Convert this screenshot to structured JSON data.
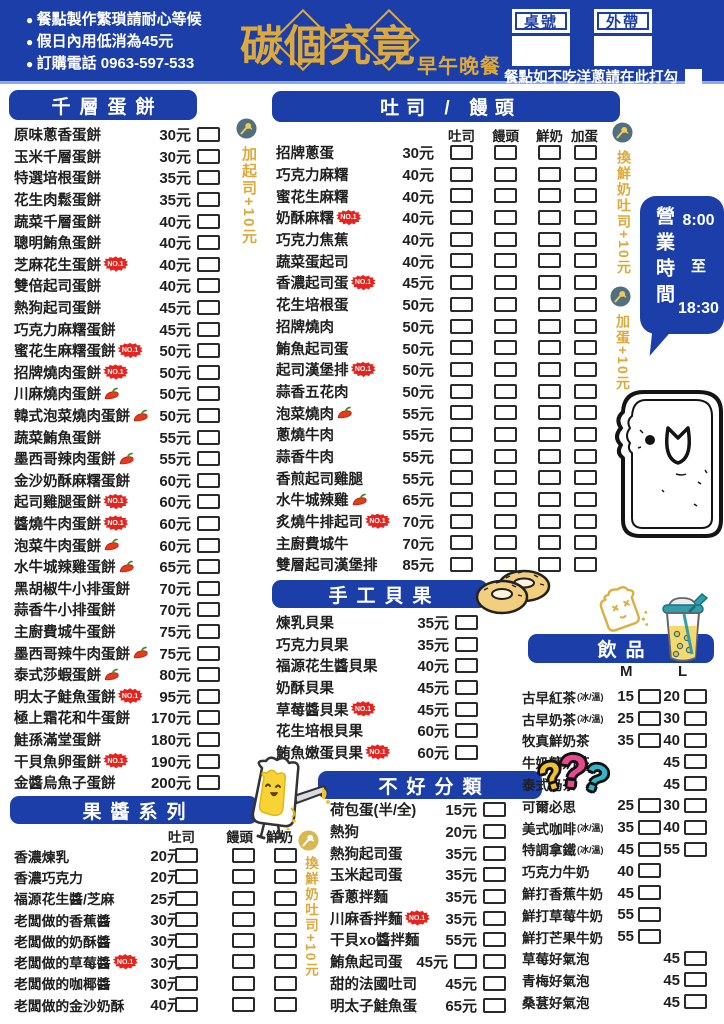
{
  "colors": {
    "blue": "#1b3ea8",
    "gold": "#dca93c",
    "badge_red": "#e8231d"
  },
  "banner": {
    "notes": [
      "餐點製作繁瑣請耐心等候",
      "假日內用低消為45元",
      "訂購電話 0963-597-533"
    ],
    "logo": "碳個究竟",
    "logo_sub": "早午晚餐",
    "table_label": "桌號",
    "takeout_label": "外帶",
    "onion_note": "餐點如不吃洋蔥請在此打勾"
  },
  "side_notes": {
    "add_cheese": "加起司+10元",
    "swap_milk_toast_right": "換鮮奶吐司+10元",
    "add_egg": "加蛋+10元",
    "swap_milk_toast_bottom": "換鮮奶吐司+10元"
  },
  "hours": {
    "title": "營業時間",
    "open": "8:00",
    "to": "至",
    "close": "18:30"
  },
  "badge_no1_label": "NO.1",
  "sections": {
    "egg_pancake": {
      "title": "千層蛋餅",
      "items": [
        {
          "name": "原味蔥香蛋餅",
          "price": "30元"
        },
        {
          "name": "玉米千層蛋餅",
          "price": "30元"
        },
        {
          "name": "特選培根蛋餅",
          "price": "35元"
        },
        {
          "name": "花生肉鬆蛋餅",
          "price": "35元"
        },
        {
          "name": "蔬菜千層蛋餅",
          "price": "40元"
        },
        {
          "name": "聰明鮪魚蛋餅",
          "price": "40元"
        },
        {
          "name": "芝麻花生蛋餅",
          "price": "40元",
          "badge": "no1"
        },
        {
          "name": "雙倍起司蛋餅",
          "price": "40元"
        },
        {
          "name": "熱狗起司蛋餅",
          "price": "45元"
        },
        {
          "name": "巧克力麻糬蛋餅",
          "price": "45元"
        },
        {
          "name": "蜜花生麻糬蛋餅",
          "price": "50元",
          "badge": "no1"
        },
        {
          "name": "招牌燒肉蛋餅",
          "price": "50元",
          "badge": "no1"
        },
        {
          "name": "川麻燒肉蛋餅",
          "price": "50元",
          "badge": "chili"
        },
        {
          "name": "韓式泡菜燒肉蛋餅",
          "price": "50元",
          "badge": "chili"
        },
        {
          "name": "蔬菜鮪魚蛋餅",
          "price": "55元"
        },
        {
          "name": "墨西哥辣肉蛋餅",
          "price": "55元",
          "badge": "chili"
        },
        {
          "name": "金沙奶酥麻糬蛋餅",
          "price": "60元"
        },
        {
          "name": "起司雞腿蛋餅",
          "price": "60元",
          "badge": "no1"
        },
        {
          "name": "醬燒牛肉蛋餅",
          "price": "60元",
          "badge": "no1"
        },
        {
          "name": "泡菜牛肉蛋餅",
          "price": "60元",
          "badge": "chili"
        },
        {
          "name": "水牛城辣雞蛋餅",
          "price": "65元",
          "badge": "chili"
        },
        {
          "name": "黑胡椒牛小排蛋餅",
          "price": "70元"
        },
        {
          "name": "蒜香牛小排蛋餅",
          "price": "70元"
        },
        {
          "name": "主廚費城牛蛋餅",
          "price": "75元"
        },
        {
          "name": "墨西哥辣牛肉蛋餅",
          "price": "75元",
          "badge": "chili"
        },
        {
          "name": "泰式莎蝦蛋餅",
          "price": "80元",
          "badge": "chili"
        },
        {
          "name": "明太子鮭魚蛋餅",
          "price": "95元",
          "badge": "no1"
        },
        {
          "name": "極上霜花和牛蛋餅",
          "price": "170元"
        },
        {
          "name": "鮭孫滿堂蛋餅",
          "price": "180元"
        },
        {
          "name": "干貝魚卵蛋餅",
          "price": "190元",
          "badge": "no1"
        },
        {
          "name": "金醬烏魚子蛋餅",
          "price": "200元"
        }
      ]
    },
    "toast_mantou": {
      "title": "吐司 / 饅頭",
      "columns": [
        "吐司",
        "饅頭",
        "鮮奶",
        "加蛋"
      ],
      "items": [
        {
          "name": "招牌蔥蛋",
          "price": "30元"
        },
        {
          "name": "巧克力麻糬",
          "price": "40元"
        },
        {
          "name": "蜜花生麻糬",
          "price": "40元"
        },
        {
          "name": "奶酥麻糬",
          "price": "40元",
          "badge": "no1"
        },
        {
          "name": "巧克力焦蕉",
          "price": "40元"
        },
        {
          "name": "蔬菜蛋起司",
          "price": "40元"
        },
        {
          "name": "香濃起司蛋",
          "price": "45元",
          "badge": "no1"
        },
        {
          "name": "花生培根蛋",
          "price": "50元"
        },
        {
          "name": "招牌燒肉",
          "price": "50元"
        },
        {
          "name": "鮪魚起司蛋",
          "price": "50元"
        },
        {
          "name": "起司漢堡排",
          "price": "50元",
          "badge": "no1"
        },
        {
          "name": "蒜香五花肉",
          "price": "50元"
        },
        {
          "name": "泡菜燒肉",
          "price": "55元",
          "badge": "chili"
        },
        {
          "name": "蔥燒牛肉",
          "price": "55元"
        },
        {
          "name": "蒜香牛肉",
          "price": "55元"
        },
        {
          "name": "香煎起司雞腿",
          "price": "55元"
        },
        {
          "name": "水牛城辣雞",
          "price": "65元",
          "badge": "chili"
        },
        {
          "name": "炙燒牛排起司",
          "price": "70元",
          "badge": "no1"
        },
        {
          "name": "主廚費城牛",
          "price": "70元"
        },
        {
          "name": "雙層起司漢堡排",
          "price": "85元"
        }
      ]
    },
    "bagel": {
      "title": "手工貝果",
      "items": [
        {
          "name": "煉乳貝果",
          "price": "35元"
        },
        {
          "name": "巧克力貝果",
          "price": "35元"
        },
        {
          "name": "福源花生醬貝果",
          "price": "40元"
        },
        {
          "name": "奶酥貝果",
          "price": "45元"
        },
        {
          "name": "草莓醬貝果",
          "price": "45元",
          "badge": "no1"
        },
        {
          "name": "花生培根貝果",
          "price": "60元"
        },
        {
          "name": "鮪魚嫩蛋貝果",
          "price": "60元",
          "badge": "no1"
        }
      ]
    },
    "jam": {
      "title": "果醬系列",
      "columns": [
        "吐司",
        "饅頭",
        "鮮奶"
      ],
      "items": [
        {
          "name": "香濃煉乳",
          "price": "20元"
        },
        {
          "name": "香濃巧克力",
          "price": "20元"
        },
        {
          "name": "福源花生醬/芝麻",
          "price": "25元"
        },
        {
          "name": "老闆做的香蕉醬",
          "price": "30元"
        },
        {
          "name": "老闆做的奶酥醬",
          "price": "30元"
        },
        {
          "name": "老闆做的草莓醬",
          "price": "30元",
          "badge": "no1"
        },
        {
          "name": "老闆做的咖椰醬",
          "price": "30元"
        },
        {
          "name": "老闆做的金沙奶酥",
          "price": "40元"
        }
      ]
    },
    "misc": {
      "title": "不好分類",
      "items": [
        {
          "name": "荷包蛋(半/全)",
          "price": "15元"
        },
        {
          "name": "熱狗",
          "price": "20元"
        },
        {
          "name": "熱狗起司蛋",
          "price": "35元"
        },
        {
          "name": "玉米起司蛋",
          "price": "35元"
        },
        {
          "name": "香蔥拌麵",
          "price": "35元"
        },
        {
          "name": "川麻香拌麵",
          "price": "35元",
          "badge": "no1"
        },
        {
          "name": "干貝xo醬拌麵",
          "price": "55元"
        },
        {
          "name": "鮪魚起司蛋",
          "price": "45元",
          "boxes": 2
        },
        {
          "name": "甜的法國吐司",
          "price": "45元"
        },
        {
          "name": "明太子鮭魚蛋",
          "price": "65元"
        }
      ]
    },
    "drinks": {
      "title": "飲品",
      "size_labels": [
        "M",
        "L"
      ],
      "items": [
        {
          "name": "古早紅茶",
          "note": "(冰/溫)",
          "m": "15",
          "l": "20"
        },
        {
          "name": "古早奶茶",
          "note": "(冰/溫)",
          "m": "25",
          "l": "30"
        },
        {
          "name": "牧真鮮奶茶",
          "m": "35",
          "l": "40"
        },
        {
          "name": "牛奶糖奶茶",
          "l": "45"
        },
        {
          "name": "泰式奶茶",
          "l": "45"
        },
        {
          "name": "可爾必思",
          "m": "25",
          "l": "30"
        },
        {
          "name": "美式咖啡",
          "note": "(冰/溫)",
          "m": "35",
          "l": "40"
        },
        {
          "name": "特調拿鐵",
          "note": "(冰/溫)",
          "m": "45",
          "l": "55"
        },
        {
          "name": "巧克力牛奶",
          "m": "40"
        },
        {
          "name": "鮮打香蕉牛奶",
          "m": "45"
        },
        {
          "name": "鮮打草莓牛奶",
          "m": "55"
        },
        {
          "name": "鮮打芒果牛奶",
          "m": "55"
        },
        {
          "name": "草莓好氣泡",
          "l": "45"
        },
        {
          "name": "青梅好氣泡",
          "l": "45"
        },
        {
          "name": "桑葚好氣泡",
          "l": "45"
        }
      ]
    }
  }
}
